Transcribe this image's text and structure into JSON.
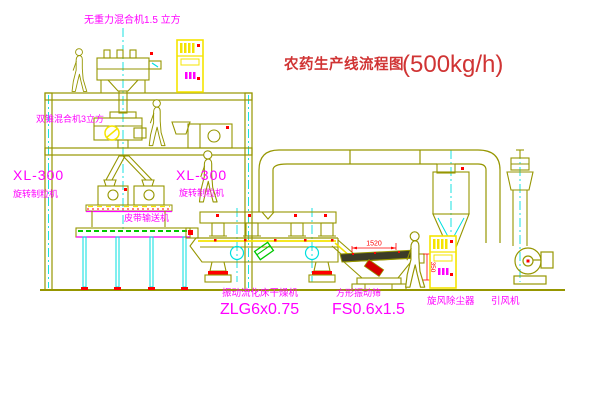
{
  "title": {
    "text": "农药生产线流程图",
    "capacity": "(500kg/h)"
  },
  "equipment": {
    "gravity_mixer": {
      "label": "无重力混合机1.5 立方"
    },
    "cone_mixer": {
      "label": "双锥混合机3立方"
    },
    "granulator_left": {
      "model": "XL-300",
      "name": "旋转制粒机"
    },
    "granulator_right": {
      "model": "XL-300",
      "name": "旋转制粒机"
    },
    "belt_conveyor": {
      "label": "皮带输送机"
    },
    "dryer": {
      "name": "振动流化床干燥机",
      "model": "ZLG6x0.75"
    },
    "sieve": {
      "name": "方形振动筛",
      "model": "FS0.6x1.5",
      "dim_length": "1520",
      "dim_outlet": "350"
    },
    "cyclone": {
      "label": "旋风除尘器"
    },
    "fan": {
      "label": "引风机"
    }
  },
  "colors": {
    "line": "#969600",
    "label": "#ff00ff",
    "title": "#d03434",
    "centerline": "#00dfdf",
    "highlight": "#f5e400",
    "accent": "#ff0000",
    "hatch": "#00c800"
  }
}
